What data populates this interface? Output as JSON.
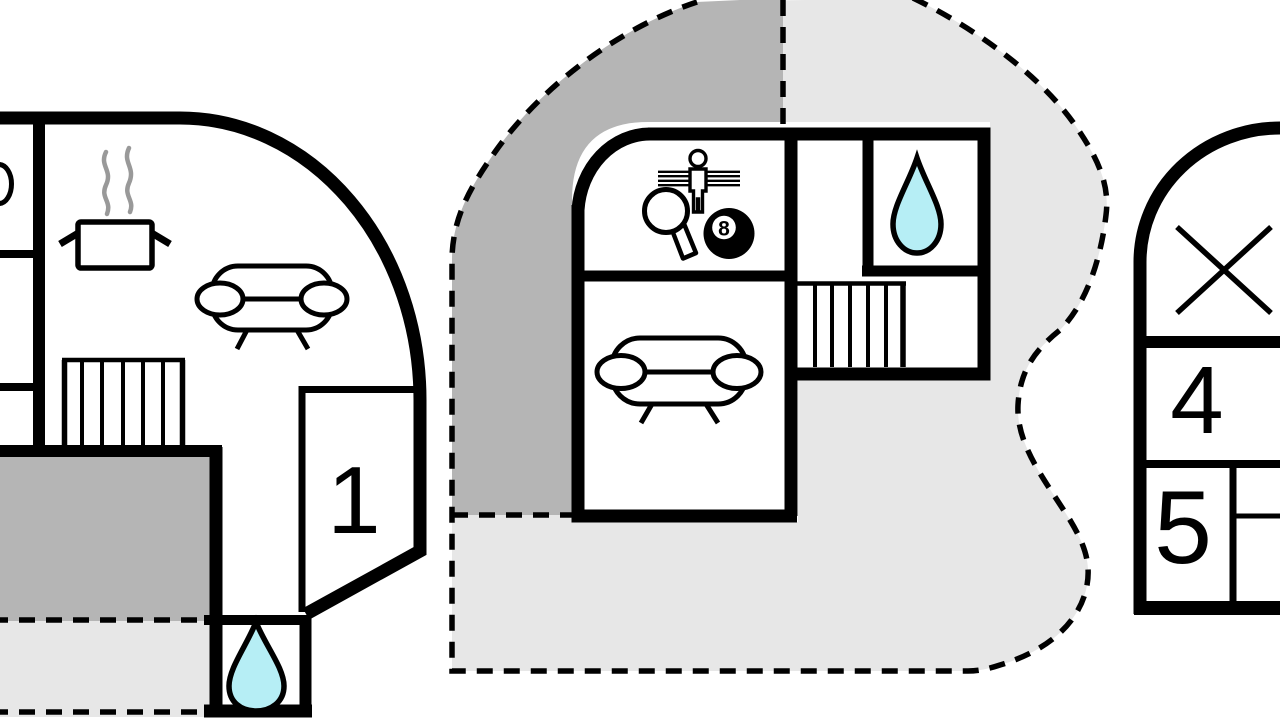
{
  "sheet": {
    "kind": "vacation-home floor plans",
    "plan_count": 3
  },
  "colors": {
    "wall": "#000000",
    "terrace_covered": "#b5b5b5",
    "terrace_open": "#e7e7e7",
    "water_drop": "#b6eef5",
    "steam": "#999999",
    "background": "#ffffff"
  },
  "left_plan": {
    "room_label": "1",
    "icons": [
      "steam-pot",
      "sofa",
      "stairs",
      "water-drop",
      "washbasin"
    ]
  },
  "middle_plan": {
    "billiard_ball_label": "8",
    "icons": [
      "foosball-player",
      "table-tennis-paddle",
      "billiard-8-ball",
      "sofa",
      "stairs",
      "water-drop"
    ]
  },
  "right_plan": {
    "room_labels": {
      "upper": "4",
      "lower": "5"
    },
    "icons": [
      "cross-mark"
    ]
  }
}
